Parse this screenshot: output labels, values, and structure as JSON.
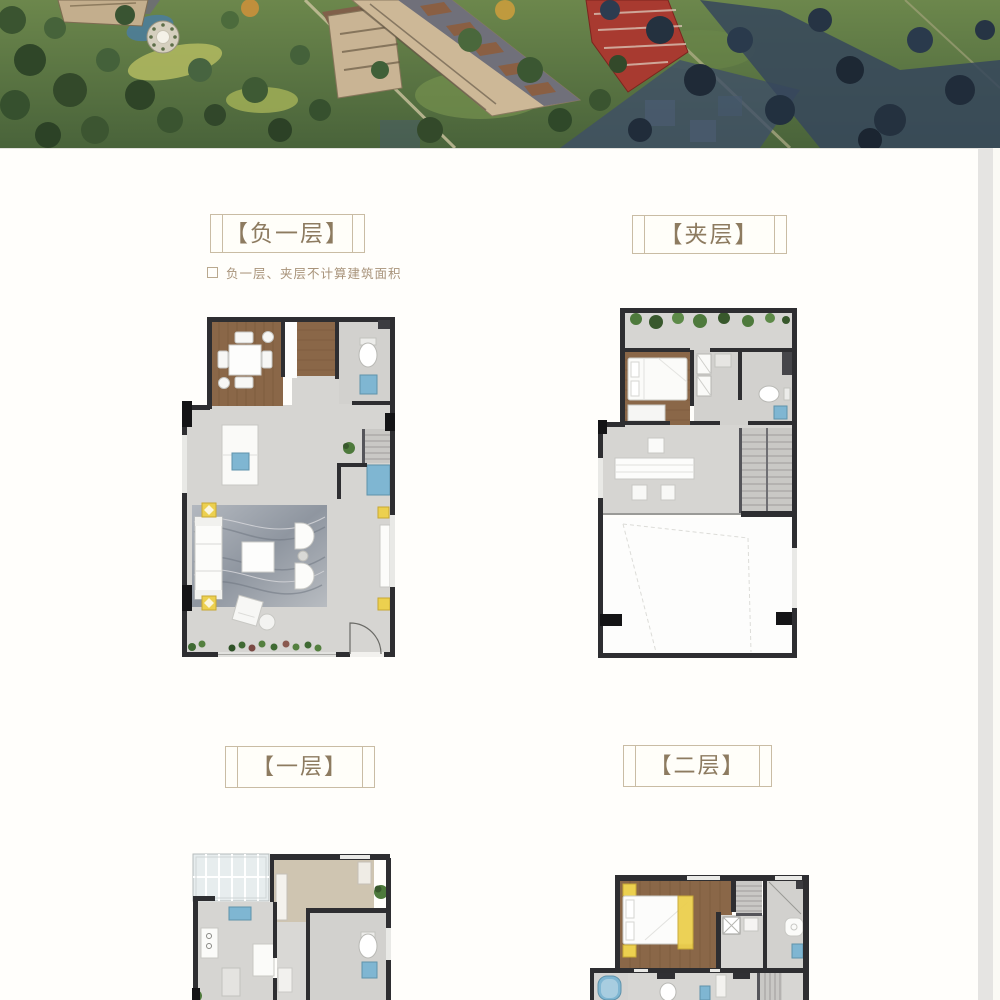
{
  "page": {
    "background": "#ffffff",
    "scrollbar_color": "#e5e4e2",
    "right_edge_color": "#fbfaf5"
  },
  "sections": {
    "basement": {
      "title": "【负一层】",
      "note": "负一层、夹层不计算建筑面积"
    },
    "mezzanine": {
      "title": "【夹层】"
    },
    "floor1": {
      "title": "【一层】"
    },
    "floor2": {
      "title": "【二层】"
    }
  },
  "palette": {
    "title_text": "#8d7b60",
    "title_border": "#c9bca4",
    "note_text": "#a8937a",
    "plan_wall": "#2e2e31",
    "plan_floor": "#d6d5d2",
    "plan_wood": "#8a6748",
    "plan_water_blue": "#7fb6d2",
    "plan_accent_yellow": "#ecd04f",
    "plan_plant_green": "#4e7a3c",
    "hero_lawn_green": "#5d7a44",
    "hero_shadow_navy": "#36465c",
    "hero_building_tan": "#cdb897",
    "hero_building_red": "#a83a30"
  }
}
